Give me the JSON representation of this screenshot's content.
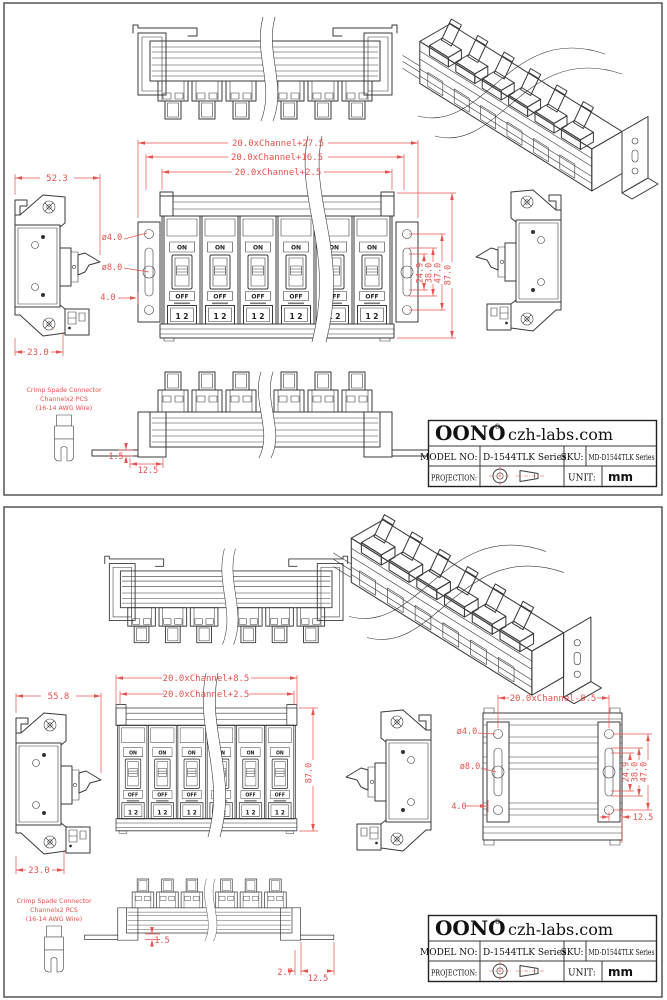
{
  "colors": {
    "dimension_red": "#e8514d",
    "drawing_line": "#3a3a3a",
    "background": "#ffffff"
  },
  "shared": {
    "switch_on": "ON",
    "switch_off": "OFF",
    "switch_terminals": "1 2",
    "note_line1": "Crimp Spade Connector",
    "note_line2": "Channelx2 PCS",
    "note_line3": "(16-14 AWG Wire)"
  },
  "title_block": {
    "brand": "OONO",
    "registered": "®",
    "site": "czh-labs.com",
    "model_label": "MODEL NO:",
    "model_value": "D-1544TLK Series",
    "sku_label": "SKU:",
    "sku_value": "MD-D1544TLK Series",
    "projection_label": "PROJECTION:",
    "unit_label": "UNIT:",
    "unit_value": "mm"
  },
  "top_panel": {
    "dims": {
      "width_overall": "20.0xChannel+27.5",
      "width_brackets": "20.0xChannel+16.5",
      "width_body": "20.0xChannel+2.5",
      "height_overall": "87.0",
      "plate_outer": "47.0",
      "plate_mid": "38.0",
      "plate_inner": "24.9",
      "hole_small": "ø4.0",
      "hole_big": "ø8.0",
      "hole_offset": "4.0",
      "side_width": "52.3",
      "side_foot": "23.0",
      "foot_thickness": "1.5",
      "foot_width": "12.5"
    }
  },
  "bottom_panel": {
    "dims": {
      "width_outer": "20.0xChannel+8.5",
      "width_body": "20.0xChannel+2.5",
      "rear_width": "20.0xChannel-8.5",
      "height_overall": "87.0",
      "plate_outer": "47.0",
      "plate_mid": "38.0",
      "plate_inner": "24.9",
      "hole_small": "ø4.0",
      "hole_big": "ø8.0",
      "hole_offset": "4.0",
      "side_width": "55.8",
      "side_foot": "23.0",
      "foot_thickness": "1.5",
      "foot_offset": "2.7",
      "foot_width": "12.5",
      "rear_foot": "12.5"
    }
  }
}
